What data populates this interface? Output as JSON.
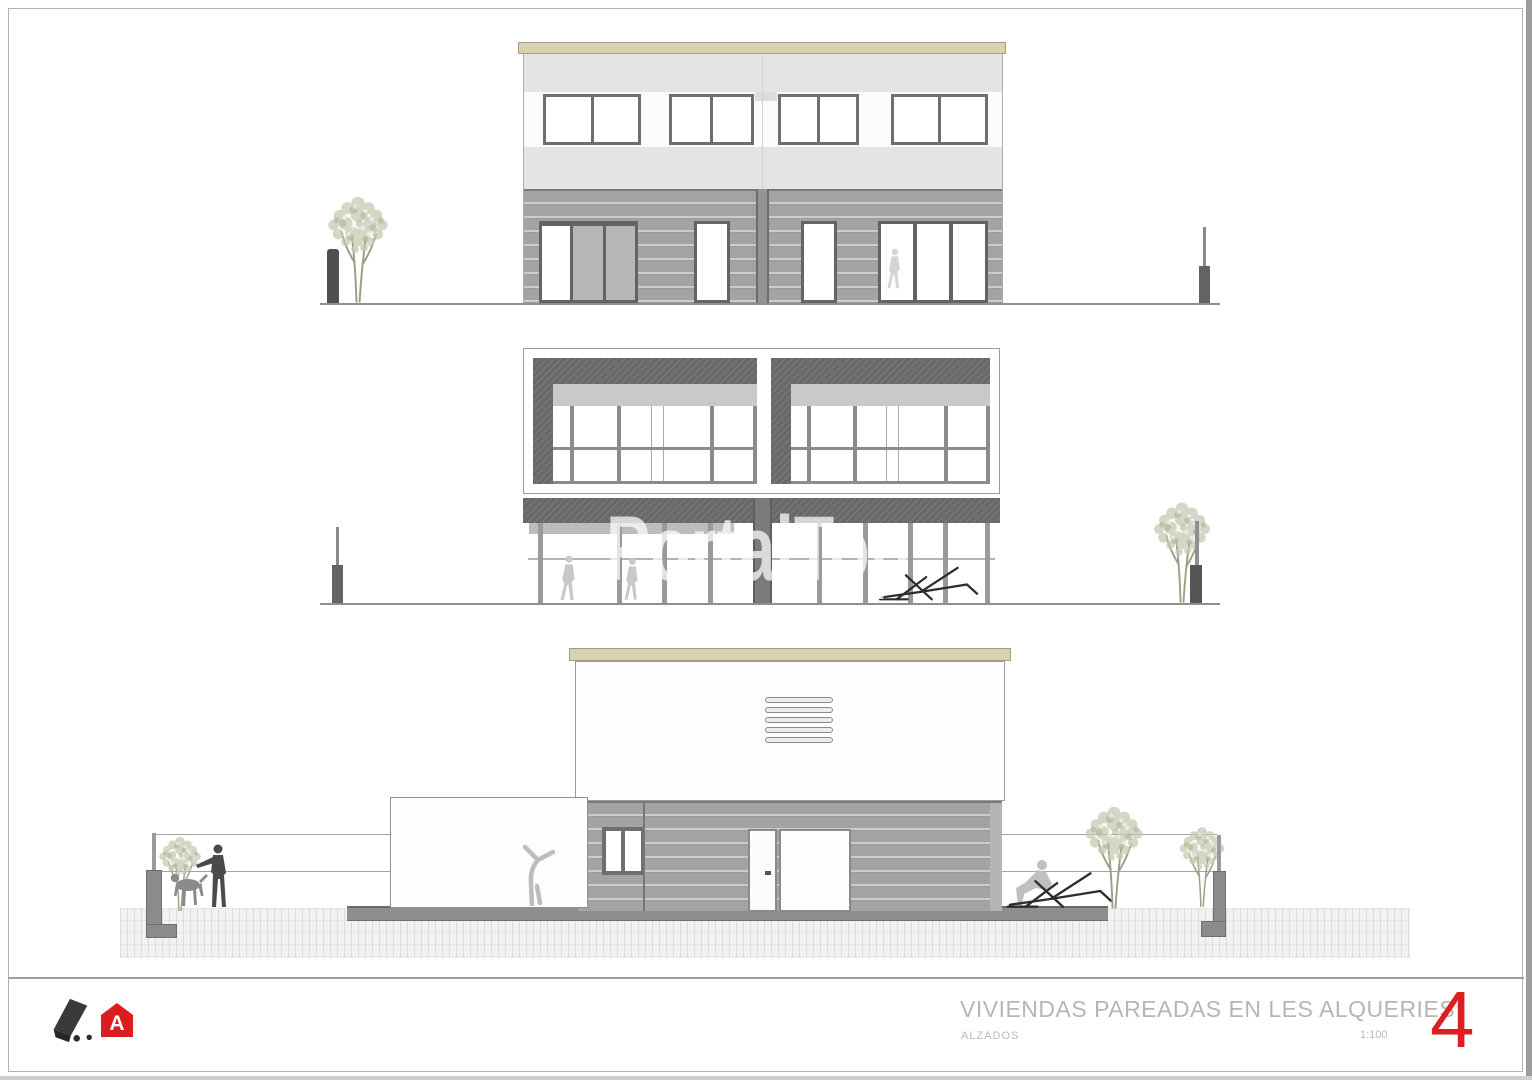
{
  "sheet": {
    "watermark": "PortalTop",
    "title": "VIVIENDAS PAREADAS EN LES ALQUERIES",
    "subtitle": "ALZADOS",
    "scale": "1:100",
    "sheet_number": "4",
    "logos": {
      "mark_icon": "architect-signature-mark",
      "house_icon": "red-house-logo",
      "house_letter": "A"
    }
  },
  "colors": {
    "accent_red": "#da2020",
    "roof_tan": "#d9d2b0",
    "siding_gray": "#a3a3a3",
    "band_gray": "#e4e4e4",
    "hatch_dark_gray": "#696969",
    "title_text_gray": "#b6b6b6",
    "watermark_white": "rgba(255,255,255,0.72)"
  }
}
